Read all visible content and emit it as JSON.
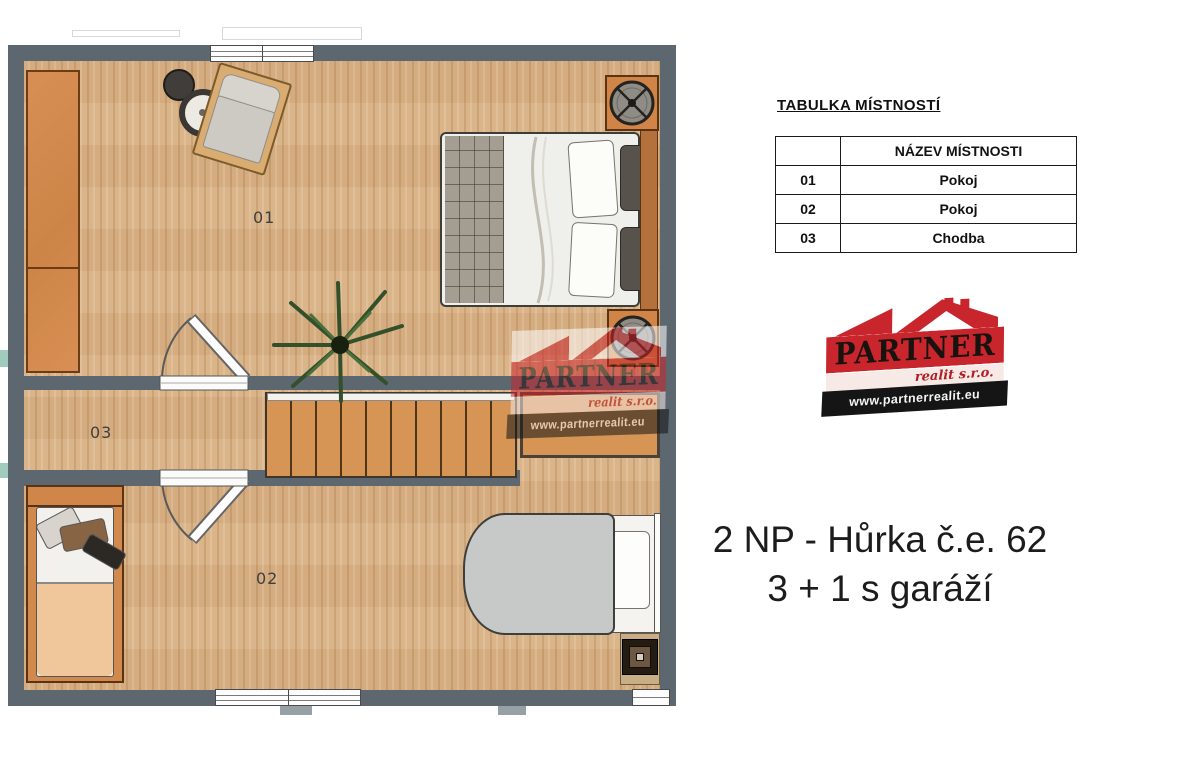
{
  "plan": {
    "room1_label": "01",
    "room2_label": "02",
    "hall_label": "03"
  },
  "rooms_table": {
    "title": "TABULKA MÍSTNOSTÍ",
    "header": {
      "id": "",
      "name": "NÁZEV MÍSTNOSTI"
    },
    "rows": [
      {
        "id": "01",
        "name": "Pokoj"
      },
      {
        "id": "02",
        "name": "Pokoj"
      },
      {
        "id": "03",
        "name": "Chodba"
      }
    ]
  },
  "logo": {
    "brand": "PARTNER",
    "sub": "realit s.r.o.",
    "url": "www.partnerrealit.eu"
  },
  "caption": {
    "line1": "2 NP - Hůrka č.e. 62",
    "line2": "3 + 1 s garáží"
  },
  "colors": {
    "wall": "#5c6770",
    "floor_wood": "#d9b184",
    "furniture_orange": "#d2894e",
    "stairs": "#d69455",
    "logo_red": "#c9252c",
    "logo_black": "#151515",
    "teal_accent": "#8fc2b1"
  }
}
